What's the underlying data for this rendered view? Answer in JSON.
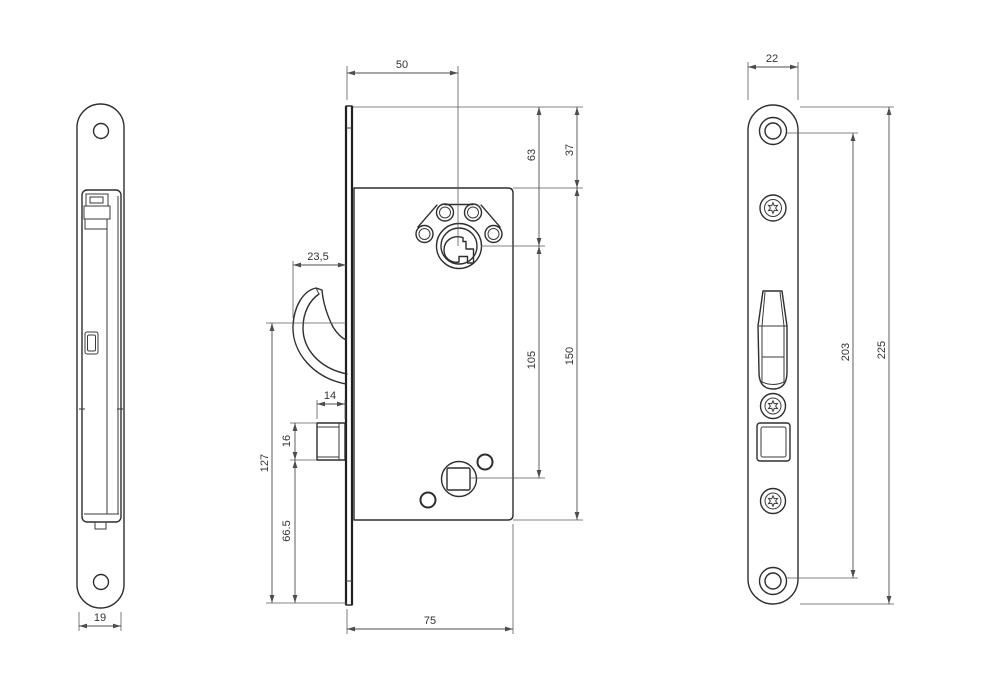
{
  "drawing": {
    "background_color": "#ffffff",
    "part_line_color": "#2e2e2e",
    "dimension_line_color": "#4d4d4d",
    "text_color": "#333333",
    "views": {
      "side_view": {
        "dims": {
          "plate_width": "19"
        }
      },
      "front_view": {
        "dims": {
          "cylinder_backset": "50",
          "cylinder_from_top": "63",
          "body_from_top": "37",
          "hook_throw": "23,5",
          "cylinder_to_follower": "105",
          "body_height": "150",
          "latch_width": "14",
          "latch_height": "16",
          "hook_to_bottom": "127",
          "latch_to_bottom": "66.5",
          "body_depth": "75"
        }
      },
      "faceplate_view": {
        "dims": {
          "plate_width": "22",
          "screw_hole_distance": "203",
          "plate_length": "225"
        }
      }
    }
  }
}
